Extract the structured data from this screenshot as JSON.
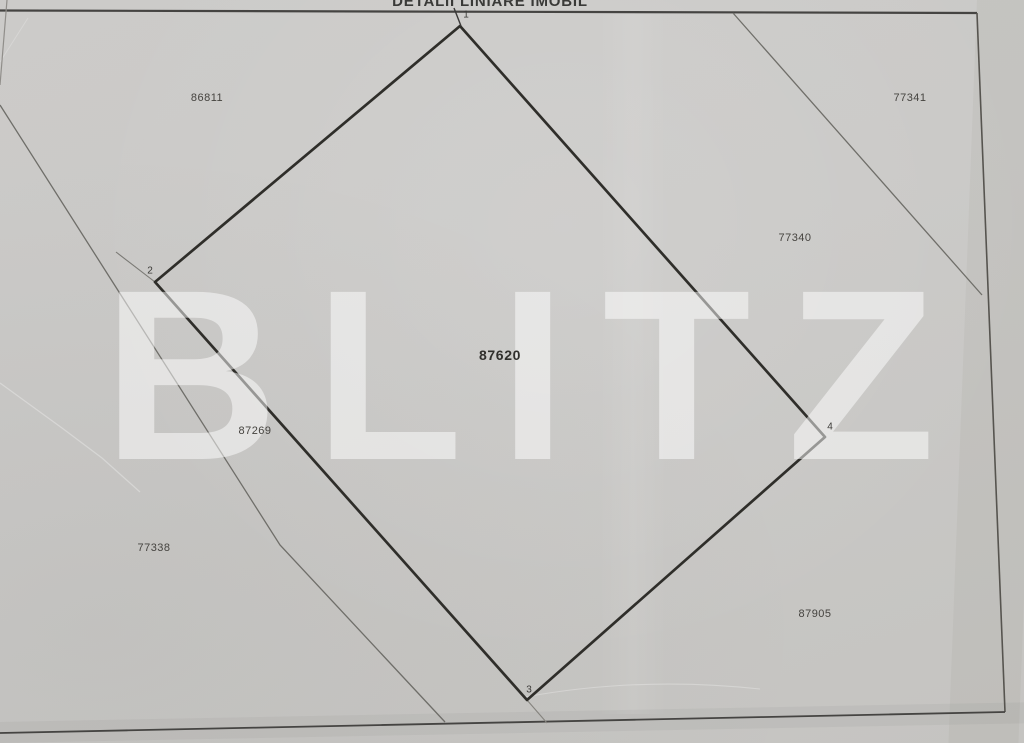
{
  "title": "DETALII LINIARE IMOBIL",
  "watermark": "BLITZ",
  "parcel": {
    "number": "87620",
    "vertex_labels": [
      "1",
      "2",
      "3",
      "4"
    ]
  },
  "neighbors": {
    "top_left": "86811",
    "top_right": "77341",
    "right": "77340",
    "left": "87269",
    "bottom_left": "77338",
    "bottom_right": "87905"
  },
  "colors": {
    "paper": "#cac9c7",
    "ink": "#2f2e2a",
    "boundary_thin": "#6f6e69",
    "watermark": "#ffffff"
  }
}
